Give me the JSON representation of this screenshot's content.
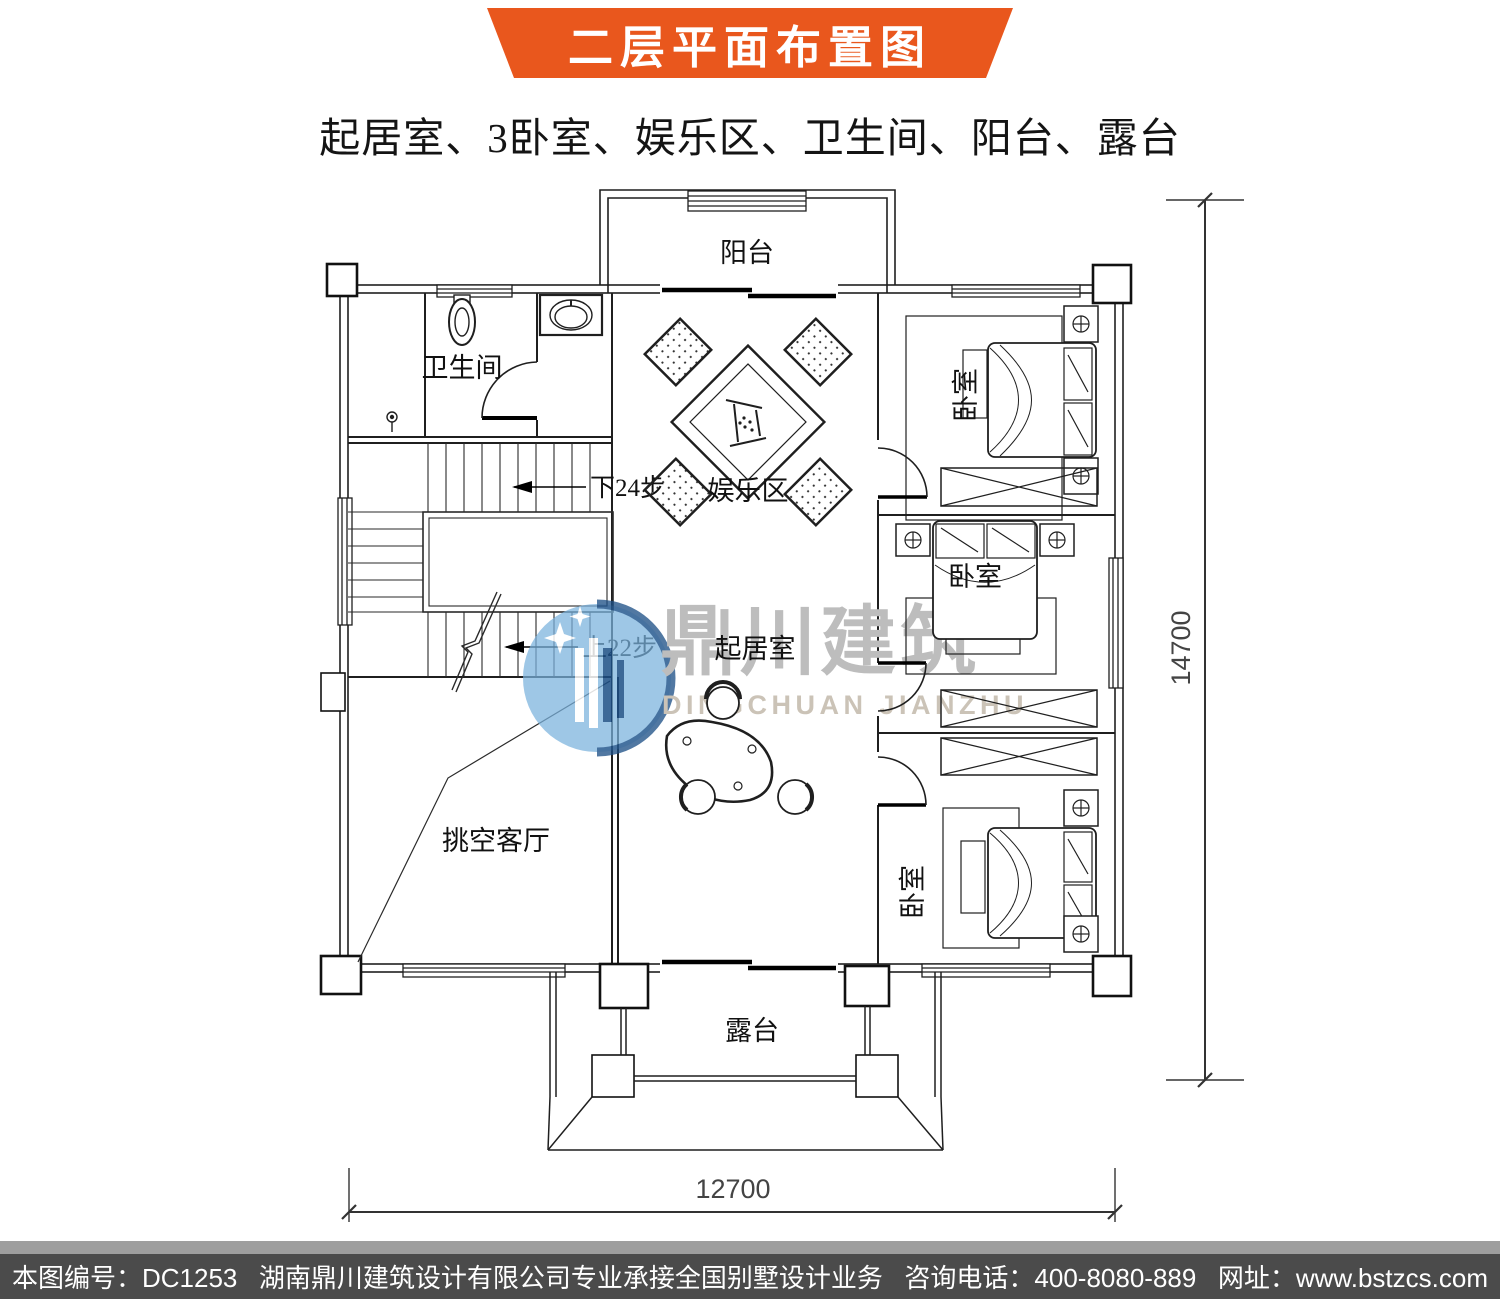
{
  "header": {
    "title": "二层平面布置图",
    "subtitle": "起居室、3卧室、娱乐区、卫生间、阳台、露台"
  },
  "plan": {
    "labels": {
      "balcony": "阳台",
      "bathroom": "卫生间",
      "entertainment": "娱乐区",
      "bedroom_top_right": "卧室",
      "bedroom_middle_right": "卧室",
      "bedroom_bottom_right": "卧室",
      "living_void": "挑空客厅",
      "living_room": "起居室",
      "terrace": "露台"
    },
    "annotations": {
      "stairs_down": "下24步",
      "stairs_up": "上22步"
    },
    "dimensions": {
      "height_mm": "14700",
      "width_mm": "12700"
    }
  },
  "watermark": {
    "name_cn": "鼎川建筑",
    "name_en": "DINGCHUAN JIANZHU"
  },
  "footer": {
    "drawing_no": "本图编号：DC1253",
    "company": "湖南鼎川建筑设计有限公司专业承接全国别墅设计业务",
    "phone": "咨询电话：400-8080-889",
    "website": "网址：www.bstzcs.com"
  },
  "colors": {
    "banner_orange": "#e9571d",
    "footer_bg": "#4b4b4b",
    "footer_strip": "#9e9e9e",
    "watermark_blue": "#79b1dd",
    "watermark_navy": "#1c4f86",
    "watermark_gray": "#bdbdbd",
    "watermark_tan": "#cbc3b7",
    "line_color": "#1f1f1f"
  }
}
